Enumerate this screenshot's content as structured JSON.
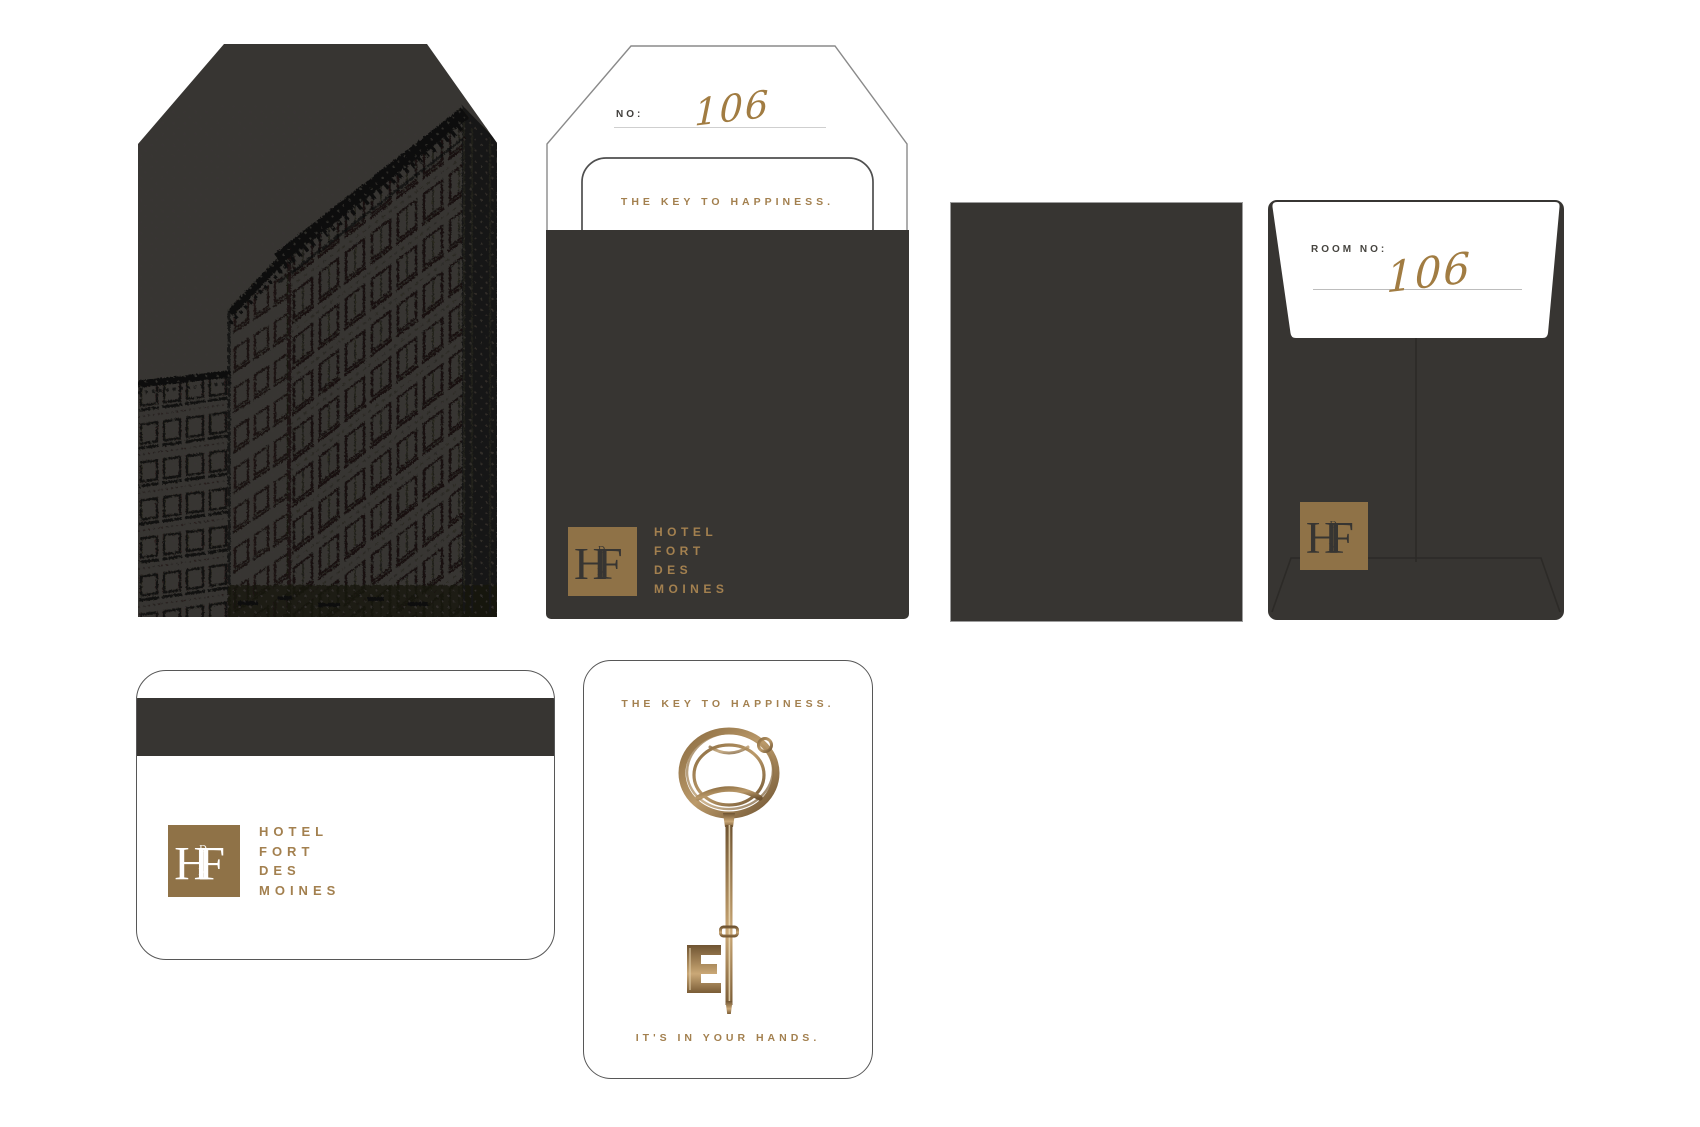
{
  "colors": {
    "charcoal": "#373532",
    "gold": "#8f7247",
    "gold_text": "#a3804f",
    "handwriting": "#a17c42"
  },
  "brand": {
    "monogram": {
      "main_left": "H",
      "main_right": "F",
      "small_top": "D",
      "small_bottom": "M"
    },
    "wordmark_lines": [
      "HOTEL",
      "FORT",
      "DES",
      "MOINES"
    ]
  },
  "key_envelope_front": {
    "number_label": "NO:",
    "room_number": "106",
    "tagline": "THE KEY TO HAPPINESS."
  },
  "key_envelope_back": {
    "number_label": "ROOM NO:",
    "room_number": "106"
  },
  "key_card_front": {
    "tagline_top": "THE KEY TO HAPPINESS.",
    "tagline_bottom": "IT'S IN YOUR HANDS."
  }
}
